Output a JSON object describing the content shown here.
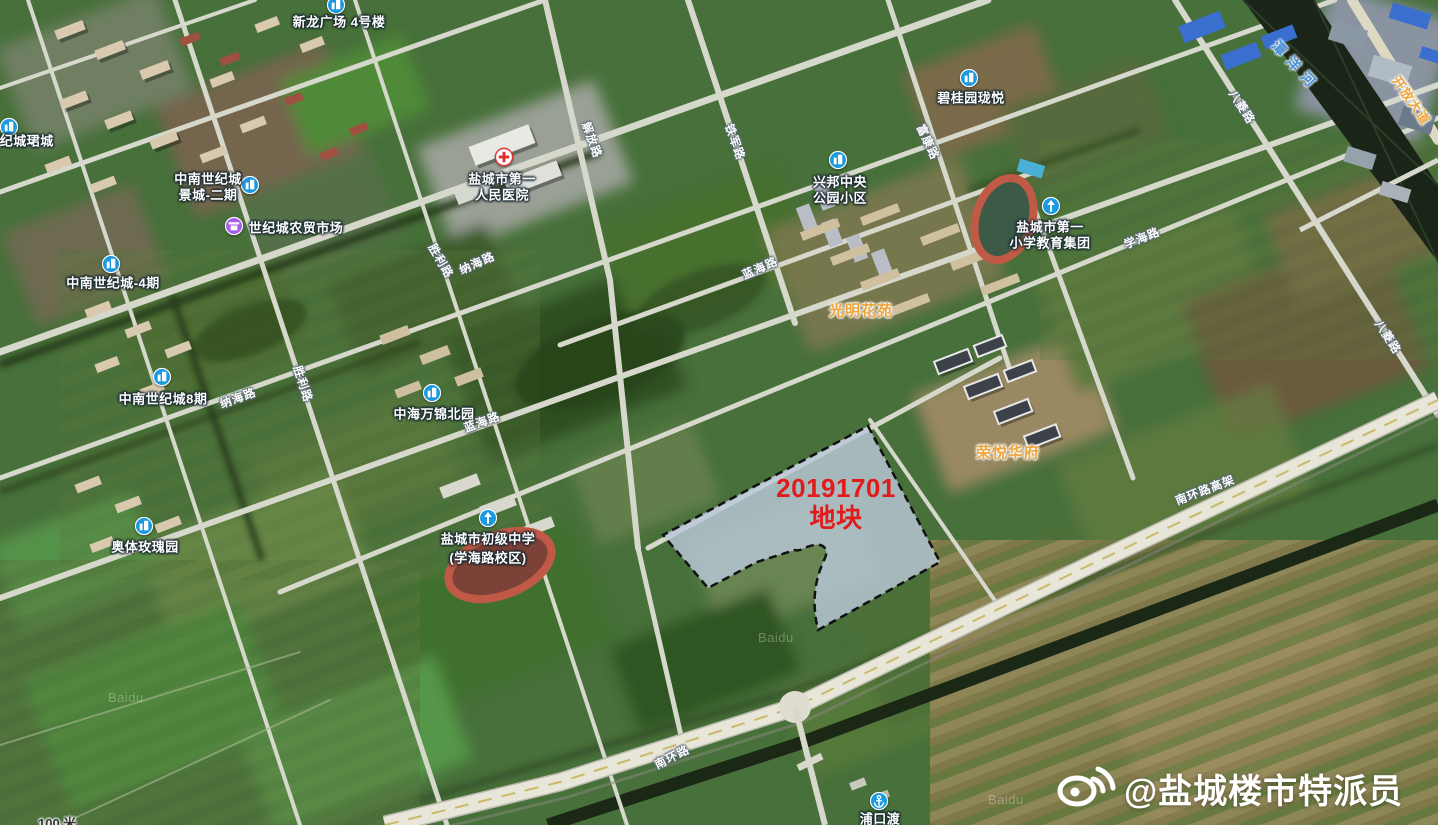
{
  "map": {
    "parcel": {
      "id_line": "20191701",
      "name_line": "地块",
      "fill": "#b9c8d8",
      "outline": "#111111",
      "text_color": "#e11b1b"
    },
    "pois": [
      {
        "id": "xinlong-plaza",
        "icon": "building",
        "icon_x": 336,
        "icon_y": 5,
        "lines": [
          {
            "text": "新龙广场 4号楼",
            "x": 339,
            "y": 21
          }
        ]
      },
      {
        "id": "shijicheng-juncheng",
        "icon": "building",
        "icon_x": 9,
        "icon_y": 127,
        "lines": [
          {
            "text": "世纪城珺城",
            "x": 20,
            "y": 140
          }
        ]
      },
      {
        "id": "zhongnan-jingcheng",
        "icon": "building",
        "icon_x": 250,
        "icon_y": 185,
        "lines": [
          {
            "text": "中南世纪城",
            "x": 208,
            "y": 178
          },
          {
            "text": "景城-二期",
            "x": 208,
            "y": 194
          }
        ]
      },
      {
        "id": "shijicheng-market",
        "icon": "market",
        "icon_x": 234,
        "icon_y": 226,
        "lines": [
          {
            "text": "世纪城农贸市场",
            "x": 296,
            "y": 227
          }
        ]
      },
      {
        "id": "zhongnan-4qi",
        "icon": "building",
        "icon_x": 111,
        "icon_y": 264,
        "lines": [
          {
            "text": "中南世纪城-4期",
            "x": 113,
            "y": 282
          }
        ]
      },
      {
        "id": "yancheng-no1-hospital",
        "icon": "hospital",
        "icon_x": 504,
        "icon_y": 157,
        "lines": [
          {
            "text": "盐城市第一",
            "x": 502,
            "y": 178
          },
          {
            "text": "人民医院",
            "x": 502,
            "y": 194
          }
        ]
      },
      {
        "id": "biguiyuan-longyue",
        "icon": "building",
        "icon_x": 969,
        "icon_y": 78,
        "lines": [
          {
            "text": "碧桂园珑悦",
            "x": 971,
            "y": 97
          }
        ]
      },
      {
        "id": "xingbang-central-park",
        "icon": "building",
        "icon_x": 838,
        "icon_y": 160,
        "lines": [
          {
            "text": "兴邦中央",
            "x": 840,
            "y": 181
          },
          {
            "text": "公园小区",
            "x": 840,
            "y": 197
          }
        ]
      },
      {
        "id": "yancheng-no1-primary",
        "icon": "school",
        "icon_x": 1051,
        "icon_y": 206,
        "lines": [
          {
            "text": "盐城市第一",
            "x": 1050,
            "y": 226
          },
          {
            "text": "小学教育集团",
            "x": 1050,
            "y": 242
          }
        ]
      },
      {
        "id": "zhongnan-8qi",
        "icon": "building",
        "icon_x": 162,
        "icon_y": 377,
        "lines": [
          {
            "text": "中南世纪城8期",
            "x": 163,
            "y": 398
          }
        ]
      },
      {
        "id": "zhonghai-wanjin",
        "icon": "building",
        "icon_x": 432,
        "icon_y": 393,
        "lines": [
          {
            "text": "中海万锦北园",
            "x": 434,
            "y": 413
          }
        ]
      },
      {
        "id": "aoti-meigui",
        "icon": "building",
        "icon_x": 144,
        "icon_y": 526,
        "lines": [
          {
            "text": "奥体玫瑰园",
            "x": 145,
            "y": 546
          }
        ]
      },
      {
        "id": "yancheng-junior-middle",
        "icon": "school",
        "icon_x": 488,
        "icon_y": 518,
        "lines": [
          {
            "text": "盐城市初级中学",
            "x": 488,
            "y": 538
          },
          {
            "text": "(学海路校区)",
            "x": 488,
            "y": 557
          }
        ]
      },
      {
        "id": "pukou-ferry",
        "icon": "anchor",
        "icon_x": 879,
        "icon_y": 801,
        "lines": [
          {
            "text": "浦口渡",
            "x": 880,
            "y": 818
          }
        ]
      }
    ],
    "area_labels": [
      {
        "text": "光明花苑",
        "x": 861,
        "y": 310
      },
      {
        "text": "荣悦华府",
        "x": 1008,
        "y": 452
      }
    ],
    "road_labels": [
      {
        "text": "解放路",
        "x": 592,
        "y": 140,
        "rot": 70
      },
      {
        "text": "铁军路",
        "x": 735,
        "y": 142,
        "rot": 70
      },
      {
        "text": "富康路",
        "x": 928,
        "y": 142,
        "rot": 65
      },
      {
        "text": "胜利路",
        "x": 441,
        "y": 261,
        "rot": 60
      },
      {
        "text": "胜利路",
        "x": 303,
        "y": 384,
        "rot": 72
      },
      {
        "text": "纳海路",
        "x": 477,
        "y": 263,
        "rot": -24
      },
      {
        "text": "纳海路",
        "x": 238,
        "y": 398,
        "rot": -20
      },
      {
        "text": "蓝海路",
        "x": 760,
        "y": 268,
        "rot": -24
      },
      {
        "text": "蓝海路",
        "x": 482,
        "y": 422,
        "rot": -20
      },
      {
        "text": "学海路",
        "x": 1142,
        "y": 238,
        "rot": -22
      },
      {
        "text": "南环路高架",
        "x": 1205,
        "y": 490,
        "rot": -21
      },
      {
        "text": "南环路",
        "x": 672,
        "y": 757,
        "rot": -27
      },
      {
        "text": "八菱路",
        "x": 1242,
        "y": 107,
        "rot": 57
      },
      {
        "text": "八菱路",
        "x": 1388,
        "y": 337,
        "rot": 57
      },
      {
        "text": "开放大道",
        "x": 1412,
        "y": 100,
        "rot": 55,
        "arterial": true
      }
    ],
    "river_labels": [
      {
        "text": "潭洋河",
        "x": 1296,
        "y": 66,
        "rot": 47
      }
    ],
    "watermarks": [
      {
        "text": "Baidu",
        "x": 108,
        "y": 690
      },
      {
        "text": "Baidu",
        "x": 758,
        "y": 630
      },
      {
        "text": "Baidu",
        "x": 988,
        "y": 792
      }
    ],
    "scale_label": {
      "text": "100 米"
    },
    "attribution": {
      "handle": "@盐城楼市特派员",
      "icon": "weibo-logo"
    }
  },
  "colors": {
    "poi_icon_blue": "#1b9ae0",
    "poi_icon_purple": "#a75fe8",
    "hospital_red": "#e03028",
    "area_label_orange": "#eda43b",
    "road_label_white": "#ffffff",
    "river_label_blue": "#4a8fd4",
    "parcel_fill": "#b9c8d8",
    "parcel_text_red": "#e11b1b"
  }
}
